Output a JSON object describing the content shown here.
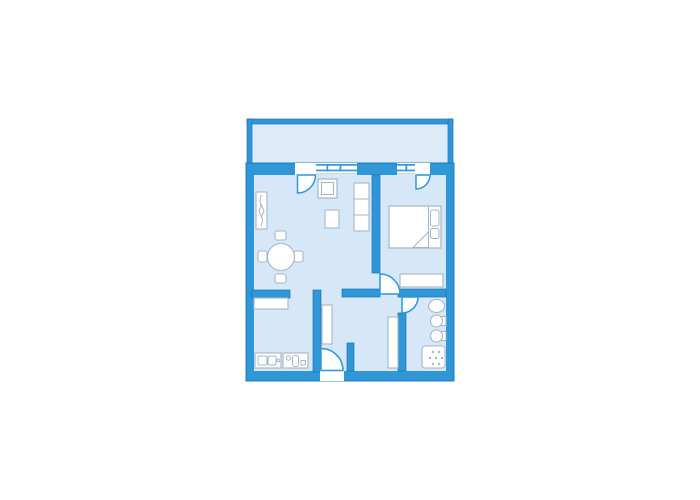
{
  "meta": {
    "description": "apartment-floor-plan",
    "colors": {
      "wall": "#2F96D8",
      "wall_edge": "#1D74AE",
      "room_floor": "#D6E7F8",
      "balcony_floor": "#DDEBF9",
      "furniture_outline": "#A6B6C6",
      "furniture_fill": "#FFFFFF",
      "background": "#FFFFFF"
    }
  },
  "shapes": [
    {
      "name": "balcony-floor",
      "kind": "rect",
      "attrs": {
        "x": 252,
        "y": 124,
        "width": 196,
        "height": 42,
        "fill": "#DDEBF9"
      }
    },
    {
      "name": "balcony-wall-top",
      "kind": "rect",
      "attrs": {
        "x": 247,
        "y": 119,
        "width": 206,
        "height": 5,
        "fill": "#2F96D8",
        "stroke": "#1D74AE",
        "stroke-width": 0.7
      }
    },
    {
      "name": "balcony-wall-left",
      "kind": "rect",
      "attrs": {
        "x": 247,
        "y": 119,
        "width": 5,
        "height": 44,
        "fill": "#2F96D8",
        "stroke": "#1D74AE",
        "stroke-width": 0.7
      }
    },
    {
      "name": "balcony-wall-right",
      "kind": "rect",
      "attrs": {
        "x": 448,
        "y": 119,
        "width": 5,
        "height": 44,
        "fill": "#2F96D8",
        "stroke": "#1D74AE",
        "stroke-width": 0.7
      }
    },
    {
      "name": "apartment-outer-wall",
      "kind": "rect",
      "attrs": {
        "x": 246,
        "y": 163,
        "width": 208,
        "height": 218,
        "fill": "#2F96D8",
        "stroke": "#1D74AE",
        "stroke-width": 0.9
      }
    },
    {
      "name": "apartment-floor",
      "kind": "rect",
      "attrs": {
        "x": 254,
        "y": 175,
        "width": 192,
        "height": 196,
        "fill": "#D6E7F8"
      }
    },
    {
      "name": "opening-living-balcony-door",
      "kind": "rect",
      "attrs": {
        "x": 295,
        "y": 163,
        "width": 21,
        "height": 12,
        "fill": "#FFFFFF"
      }
    },
    {
      "name": "window-living-band",
      "kind": "rect",
      "attrs": {
        "x": 316,
        "y": 163,
        "width": 41,
        "height": 12,
        "fill": "#FFFFFF"
      }
    },
    {
      "name": "window-living-line-outer",
      "kind": "rect",
      "attrs": {
        "x": 316,
        "y": 164,
        "width": 41,
        "height": 1.7,
        "fill": "#2F96D8"
      }
    },
    {
      "name": "window-living-line-inner",
      "kind": "rect",
      "attrs": {
        "x": 316,
        "y": 169.6,
        "width": 41,
        "height": 1.7,
        "fill": "#2F96D8"
      }
    },
    {
      "name": "window-living-tick-1",
      "kind": "rect",
      "attrs": {
        "x": 326.5,
        "y": 164,
        "width": 1.7,
        "height": 7.3,
        "fill": "#2F96D8"
      }
    },
    {
      "name": "window-living-tick-2",
      "kind": "rect",
      "attrs": {
        "x": 339.5,
        "y": 164,
        "width": 1.7,
        "height": 7.3,
        "fill": "#2F96D8"
      }
    },
    {
      "name": "window-living-sill",
      "kind": "rect",
      "attrs": {
        "x": 316,
        "y": 173.4,
        "width": 41,
        "height": 1,
        "fill": "#A9BED2"
      }
    },
    {
      "name": "window-bedroom-band",
      "kind": "rect",
      "attrs": {
        "x": 397,
        "y": 163,
        "width": 18,
        "height": 12,
        "fill": "#FFFFFF"
      }
    },
    {
      "name": "window-bedroom-line-outer",
      "kind": "rect",
      "attrs": {
        "x": 397,
        "y": 164,
        "width": 18,
        "height": 1.7,
        "fill": "#2F96D8"
      }
    },
    {
      "name": "window-bedroom-line-inner",
      "kind": "rect",
      "attrs": {
        "x": 397,
        "y": 169.6,
        "width": 18,
        "height": 1.7,
        "fill": "#2F96D8"
      }
    },
    {
      "name": "window-bedroom-tick",
      "kind": "rect",
      "attrs": {
        "x": 405.5,
        "y": 164,
        "width": 1.7,
        "height": 7.3,
        "fill": "#2F96D8"
      }
    },
    {
      "name": "window-bedroom-sill",
      "kind": "rect",
      "attrs": {
        "x": 397,
        "y": 173.4,
        "width": 18,
        "height": 1,
        "fill": "#A9BED2"
      }
    },
    {
      "name": "opening-bedroom-balcony-door",
      "kind": "rect",
      "attrs": {
        "x": 415,
        "y": 163,
        "width": 15,
        "height": 12,
        "fill": "#FFFFFF"
      }
    },
    {
      "name": "interior-wall-living-bedroom",
      "kind": "rect",
      "attrs": {
        "x": 372,
        "y": 175,
        "width": 8,
        "height": 98,
        "fill": "#2F96D8",
        "stroke": "#1D74AE",
        "stroke-width": 0.7
      }
    },
    {
      "name": "interior-wall-living-kitchen",
      "kind": "rect",
      "attrs": {
        "x": 252,
        "y": 290,
        "width": 38,
        "height": 8,
        "fill": "#2F96D8",
        "stroke": "#1D74AE",
        "stroke-width": 0.7
      }
    },
    {
      "name": "interior-wall-kitchen-hall",
      "kind": "rect",
      "attrs": {
        "x": 313,
        "y": 290,
        "width": 8,
        "height": 82,
        "fill": "#2F96D8",
        "stroke": "#1D74AE",
        "stroke-width": 0.7
      }
    },
    {
      "name": "interior-wall-living-hall",
      "kind": "rect",
      "attrs": {
        "x": 342,
        "y": 289,
        "width": 38,
        "height": 8,
        "fill": "#2F96D8",
        "stroke": "#1D74AE",
        "stroke-width": 0.7
      }
    },
    {
      "name": "interior-wall-bedroom-bottom",
      "kind": "rect",
      "attrs": {
        "x": 398,
        "y": 289,
        "width": 48,
        "height": 8,
        "fill": "#2F96D8",
        "stroke": "#1D74AE",
        "stroke-width": 0.7
      }
    },
    {
      "name": "interior-wall-hall-bath",
      "kind": "rect",
      "attrs": {
        "x": 398,
        "y": 313,
        "width": 8,
        "height": 58,
        "fill": "#2F96D8",
        "stroke": "#1D74AE",
        "stroke-width": 0.7
      }
    },
    {
      "name": "interior-wall-entry-stub",
      "kind": "rect",
      "attrs": {
        "x": 347,
        "y": 343,
        "width": 7,
        "height": 28,
        "fill": "#2F96D8",
        "stroke": "#1D74AE",
        "stroke-width": 0.7
      }
    },
    {
      "name": "opening-entrance",
      "kind": "rect",
      "attrs": {
        "x": 320,
        "y": 370,
        "width": 24,
        "height": 11,
        "fill": "#FFFFFF"
      }
    },
    {
      "name": "furniture-coat-stand",
      "kind": "rect",
      "attrs": {
        "x": 256,
        "y": 192,
        "width": 11,
        "height": 37,
        "fill": "#FFFFFF",
        "stroke": "#A6B6C6",
        "stroke-width": 1.1
      }
    },
    {
      "name": "furniture-coat-stand-squiggle",
      "kind": "path",
      "attrs": {
        "d": "M 261.5 195 Q 258.5 201 261.5 207 L 261.5 216 Q 263.5 221 261 226",
        "fill": "none",
        "stroke": "#A6B6C6",
        "stroke-width": 1
      }
    },
    {
      "name": "furniture-coat-stand-diamond",
      "kind": "polygon",
      "attrs": {
        "points": "261.5,205 264,211 261.5,217 259,211",
        "fill": "#FFFFFF",
        "stroke": "#A6B6C6",
        "stroke-width": 1
      }
    },
    {
      "name": "furniture-armchair",
      "kind": "rect",
      "attrs": {
        "x": 318,
        "y": 179,
        "width": 19,
        "height": 19,
        "fill": "#FFFFFF",
        "stroke": "#A6B6C6",
        "stroke-width": 1.2
      }
    },
    {
      "name": "furniture-armchair-seat",
      "kind": "rect",
      "attrs": {
        "x": 321.5,
        "y": 182.5,
        "width": 12,
        "height": 12,
        "fill": "#FFFFFF",
        "stroke": "#A6B6C6",
        "stroke-width": 1.1
      }
    },
    {
      "name": "furniture-coffee-table",
      "kind": "rect",
      "attrs": {
        "x": 325,
        "y": 210,
        "width": 14,
        "height": 18,
        "fill": "#FFFFFF",
        "stroke": "#A6B6C6",
        "stroke-width": 1.1
      }
    },
    {
      "name": "furniture-shelf",
      "kind": "rect",
      "attrs": {
        "x": 354,
        "y": 183,
        "width": 15,
        "height": 48,
        "fill": "#FFFFFF",
        "stroke": "#A6B6C6",
        "stroke-width": 1.1
      }
    },
    {
      "name": "furniture-shelf-divider-1",
      "kind": "line",
      "attrs": {
        "x1": 354,
        "y1": 199,
        "x2": 369,
        "y2": 199,
        "stroke": "#A6B6C6",
        "stroke-width": 1
      }
    },
    {
      "name": "furniture-shelf-divider-2",
      "kind": "line",
      "attrs": {
        "x1": 354,
        "y1": 215,
        "x2": 369,
        "y2": 215,
        "stroke": "#A6B6C6",
        "stroke-width": 1
      }
    },
    {
      "name": "furniture-dining-chair-top",
      "kind": "rect",
      "attrs": {
        "x": 275,
        "y": 231,
        "width": 11,
        "height": 9,
        "rx": 2,
        "fill": "#FFFFFF",
        "stroke": "#A6B6C6",
        "stroke-width": 1.1
      }
    },
    {
      "name": "furniture-dining-chair-bottom",
      "kind": "rect",
      "attrs": {
        "x": 275,
        "y": 274,
        "width": 11,
        "height": 9,
        "rx": 2,
        "fill": "#FFFFFF",
        "stroke": "#A6B6C6",
        "stroke-width": 1.1
      }
    },
    {
      "name": "furniture-dining-chair-left",
      "kind": "rect",
      "attrs": {
        "x": 258,
        "y": 251,
        "width": 9,
        "height": 11,
        "rx": 2,
        "fill": "#FFFFFF",
        "stroke": "#A6B6C6",
        "stroke-width": 1.1
      }
    },
    {
      "name": "furniture-dining-chair-right",
      "kind": "rect",
      "attrs": {
        "x": 294,
        "y": 251,
        "width": 9,
        "height": 11,
        "rx": 2,
        "fill": "#FFFFFF",
        "stroke": "#A6B6C6",
        "stroke-width": 1.1
      }
    },
    {
      "name": "furniture-dining-table",
      "kind": "circle",
      "attrs": {
        "cx": 281,
        "cy": 257,
        "r": 13.5,
        "fill": "#FFFFFF",
        "stroke": "#A6B6C6",
        "stroke-width": 1.1
      }
    },
    {
      "name": "furniture-kitchen-cabinet",
      "kind": "rect",
      "attrs": {
        "x": 254,
        "y": 298,
        "width": 34,
        "height": 11,
        "fill": "#FFFFFF",
        "stroke": "#A6B6C6",
        "stroke-width": 1.1
      }
    },
    {
      "name": "furniture-kitchen-sink-counter",
      "kind": "rect",
      "attrs": {
        "x": 255,
        "y": 353,
        "width": 26,
        "height": 15,
        "fill": "#FFFFFF",
        "stroke": "#A6B6C6",
        "stroke-width": 1.1
      }
    },
    {
      "name": "kitchen-sink-bowl-left",
      "kind": "rect",
      "attrs": {
        "x": 258,
        "y": 356,
        "width": 9,
        "height": 9,
        "rx": 1.5,
        "fill": "#FFFFFF",
        "stroke": "#A6B6C6",
        "stroke-width": 1
      }
    },
    {
      "name": "kitchen-sink-bowl-right",
      "kind": "rect",
      "attrs": {
        "x": 268,
        "y": 356,
        "width": 8,
        "height": 9,
        "rx": 1.5,
        "fill": "#FFFFFF",
        "stroke": "#A6B6C6",
        "stroke-width": 1
      }
    },
    {
      "name": "kitchen-sink-tap",
      "kind": "circle",
      "attrs": {
        "cx": 278.3,
        "cy": 360.5,
        "r": 1.4,
        "fill": "#FFFFFF",
        "stroke": "#A6B6C6",
        "stroke-width": 1
      }
    },
    {
      "name": "furniture-kitchen-stove-counter",
      "kind": "rect",
      "attrs": {
        "x": 283,
        "y": 353,
        "width": 25,
        "height": 15,
        "fill": "#FFFFFF",
        "stroke": "#A6B6C6",
        "stroke-width": 1.1
      }
    },
    {
      "name": "kitchen-stove-burner",
      "kind": "circle",
      "attrs": {
        "cx": 288.5,
        "cy": 358,
        "r": 2.2,
        "fill": "#FFFFFF",
        "stroke": "#A6B6C6",
        "stroke-width": 1
      }
    },
    {
      "name": "kitchen-stove-pill",
      "kind": "rect",
      "attrs": {
        "x": 292.5,
        "y": 355.5,
        "width": 6,
        "height": 11,
        "rx": 2.5,
        "fill": "#FFFFFF",
        "stroke": "#A6B6C6",
        "stroke-width": 1
      }
    },
    {
      "name": "kitchen-stove-knob",
      "kind": "rect",
      "attrs": {
        "x": 301,
        "y": 360.5,
        "width": 4.5,
        "height": 4.5,
        "rx": 1,
        "fill": "#FFFFFF",
        "stroke": "#A6B6C6",
        "stroke-width": 1
      }
    },
    {
      "name": "furniture-hall-closet-left",
      "kind": "rect",
      "attrs": {
        "x": 322,
        "y": 305,
        "width": 10,
        "height": 39,
        "fill": "#FFFFFF",
        "stroke": "#A6B6C6",
        "stroke-width": 1.1
      }
    },
    {
      "name": "furniture-hall-closet-right",
      "kind": "rect",
      "attrs": {
        "x": 388,
        "y": 317,
        "width": 10,
        "height": 51,
        "fill": "#FFFFFF",
        "stroke": "#A6B6C6",
        "stroke-width": 1.1
      }
    },
    {
      "name": "furniture-bed",
      "kind": "rect",
      "attrs": {
        "x": 389,
        "y": 206,
        "width": 52,
        "height": 42,
        "fill": "#FFFFFF",
        "stroke": "#A6B6C6",
        "stroke-width": 1.2
      }
    },
    {
      "name": "bed-head-line",
      "kind": "line",
      "attrs": {
        "x1": 428.5,
        "y1": 206,
        "x2": 428.5,
        "y2": 248,
        "stroke": "#A6B6C6",
        "stroke-width": 1
      }
    },
    {
      "name": "bed-pillow-top",
      "kind": "rect",
      "attrs": {
        "x": 430.5,
        "y": 210,
        "width": 8.5,
        "height": 16,
        "rx": 2,
        "fill": "#FFFFFF",
        "stroke": "#A6B6C6",
        "stroke-width": 1
      }
    },
    {
      "name": "bed-pillow-bottom",
      "kind": "rect",
      "attrs": {
        "x": 430.5,
        "y": 228.5,
        "width": 8.5,
        "height": 10,
        "rx": 2,
        "fill": "#FFFFFF",
        "stroke": "#A6B6C6",
        "stroke-width": 1
      }
    },
    {
      "name": "bed-blanket-fold",
      "kind": "polygon",
      "attrs": {
        "points": "413,247.5 428.5,232 428.5,247.5",
        "fill": "#FFFFFF",
        "stroke": "#A6B6C6",
        "stroke-width": 1
      }
    },
    {
      "name": "furniture-bedroom-dresser",
      "kind": "rect",
      "attrs": {
        "x": 400,
        "y": 274,
        "width": 43,
        "height": 13,
        "fill": "#FFFFFF",
        "stroke": "#A6B6C6",
        "stroke-width": 1.1
      }
    },
    {
      "name": "bathroom-sink",
      "kind": "ellipse",
      "attrs": {
        "cx": 436.5,
        "cy": 306,
        "rx": 8,
        "ry": 6.5,
        "fill": "#FFFFFF",
        "stroke": "#A6B6C6",
        "stroke-width": 1.1
      }
    },
    {
      "name": "bathroom-toilet-tank",
      "kind": "rect",
      "attrs": {
        "x": 441.5,
        "y": 316.5,
        "width": 4.5,
        "height": 9,
        "fill": "#FFFFFF",
        "stroke": "#A6B6C6",
        "stroke-width": 1
      }
    },
    {
      "name": "bathroom-toilet-bowl",
      "kind": "circle",
      "attrs": {
        "cx": 436.5,
        "cy": 321,
        "r": 6,
        "fill": "#FFFFFF",
        "stroke": "#A6B6C6",
        "stroke-width": 1.1
      }
    },
    {
      "name": "bathroom-bidet-tank",
      "kind": "rect",
      "attrs": {
        "x": 441.5,
        "y": 331.5,
        "width": 4.5,
        "height": 9,
        "fill": "#FFFFFF",
        "stroke": "#A6B6C6",
        "stroke-width": 1
      }
    },
    {
      "name": "bathroom-bidet-bowl",
      "kind": "circle",
      "attrs": {
        "cx": 436.5,
        "cy": 336,
        "r": 6,
        "fill": "#FFFFFF",
        "stroke": "#A6B6C6",
        "stroke-width": 1.1
      }
    },
    {
      "name": "bathroom-shower-tray",
      "kind": "rect",
      "attrs": {
        "x": 422,
        "y": 346,
        "width": 23,
        "height": 22,
        "rx": 3,
        "fill": "#FFFFFF",
        "stroke": "#A6B6C6",
        "stroke-width": 1.1
      }
    },
    {
      "name": "shower-dot-1",
      "kind": "circle",
      "attrs": {
        "cx": 433,
        "cy": 352,
        "r": 1.2,
        "fill": "#A6B6C6"
      }
    },
    {
      "name": "shower-dot-2",
      "kind": "circle",
      "attrs": {
        "cx": 439,
        "cy": 352,
        "r": 1.2,
        "fill": "#A6B6C6"
      }
    },
    {
      "name": "shower-dot-3",
      "kind": "circle",
      "attrs": {
        "cx": 430,
        "cy": 358,
        "r": 1.2,
        "fill": "#A6B6C6"
      }
    },
    {
      "name": "shower-dot-4",
      "kind": "circle",
      "attrs": {
        "cx": 436,
        "cy": 358,
        "r": 1.2,
        "fill": "#A6B6C6"
      }
    },
    {
      "name": "shower-dot-5",
      "kind": "circle",
      "attrs": {
        "cx": 442,
        "cy": 358,
        "r": 1.2,
        "fill": "#A6B6C6"
      }
    },
    {
      "name": "shower-dot-6",
      "kind": "circle",
      "attrs": {
        "cx": 433,
        "cy": 364,
        "r": 1.2,
        "fill": "#A6B6C6"
      }
    },
    {
      "name": "shower-dot-7",
      "kind": "circle",
      "attrs": {
        "cx": 439,
        "cy": 364,
        "r": 1.2,
        "fill": "#A6B6C6"
      }
    },
    {
      "name": "door-living-balcony",
      "kind": "path",
      "attrs": {
        "d": "M 297.5 175 L 297.5 193 A 18 18 0 0 0 315.5 175 Z",
        "fill": "#FFFFFF",
        "stroke": "#2F96D8",
        "stroke-width": 1.5
      }
    },
    {
      "name": "door-bedroom-balcony",
      "kind": "path",
      "attrs": {
        "d": "M 416 175 L 416 189 A 14 14 0 0 0 430 175 Z",
        "fill": "#FFFFFF",
        "stroke": "#2F96D8",
        "stroke-width": 1.5
      }
    },
    {
      "name": "door-bedroom",
      "kind": "path",
      "attrs": {
        "d": "M 380 294 L 380 274 A 20 20 0 0 1 400 294 Z",
        "fill": "#FFFFFF",
        "stroke": "#2F96D8",
        "stroke-width": 1.5
      }
    },
    {
      "name": "door-bathroom",
      "kind": "path",
      "attrs": {
        "d": "M 402 297 L 418 297 A 16 16 0 0 1 402 313 Z",
        "fill": "#FFFFFF",
        "stroke": "#2F96D8",
        "stroke-width": 1.5
      }
    },
    {
      "name": "door-entrance",
      "kind": "path",
      "attrs": {
        "d": "M 321 370.5 L 321 348.5 A 22 22 0 0 1 343 370.5 Z",
        "fill": "#FFFFFF",
        "stroke": "#2F96D8",
        "stroke-width": 1.5
      }
    }
  ]
}
